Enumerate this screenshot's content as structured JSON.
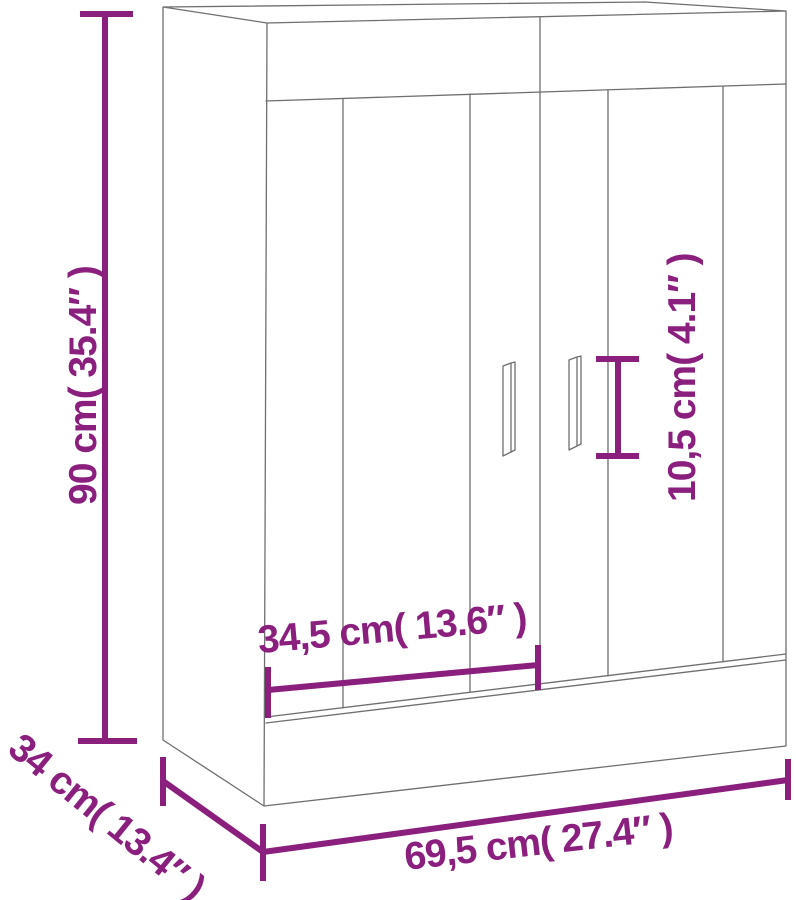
{
  "diagram": {
    "kind": "product-dimension-line-drawing",
    "subject": "two-door wall cabinet"
  },
  "dimensions": {
    "height": {
      "label": "90 cm( 35.4″ )"
    },
    "depth": {
      "label": "34 cm( 13.4″ )"
    },
    "width": {
      "label": "69,5 cm( 27.4″ )"
    },
    "door_width": {
      "label": "34,5 cm( 13.6″ )"
    },
    "handle_height": {
      "label": "10,5 cm( 4.1″ )"
    }
  },
  "colors": {
    "dimension_accent": "#8a1f7e",
    "cabinet_outline": "#6f6f6f",
    "background": "#ffffff"
  }
}
